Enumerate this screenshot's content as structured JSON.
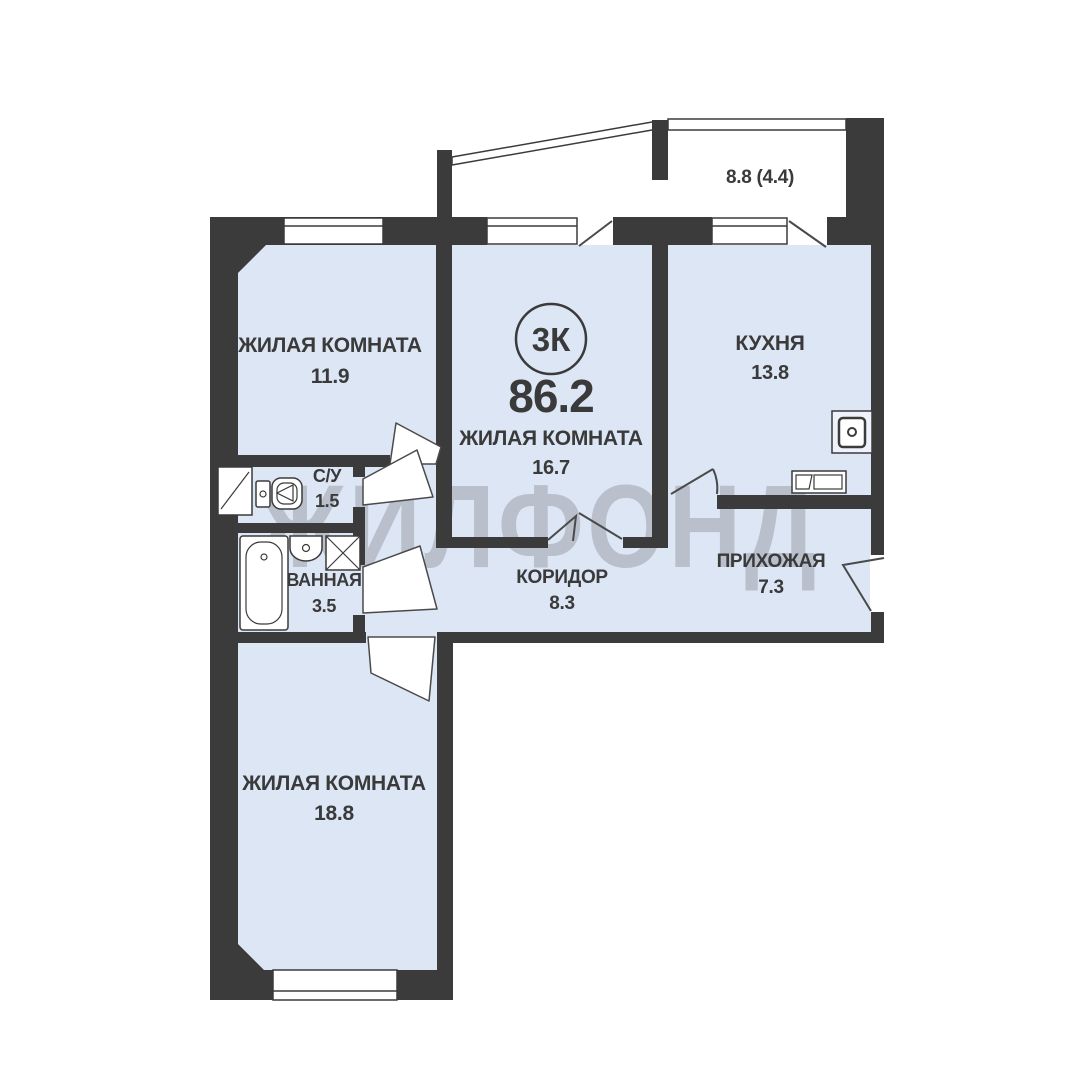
{
  "watermark": "ЖИЛФОНД",
  "badge_label": "3К",
  "total_area": "86.2",
  "balcony_area": "8.8 (4.4)",
  "rooms": {
    "living1": {
      "name": "ЖИЛАЯ КОМНАТА",
      "area": "11.9"
    },
    "living2": {
      "name": "ЖИЛАЯ КОМНАТА",
      "area": "16.7"
    },
    "kitchen": {
      "name": "КУХНЯ",
      "area": "13.8"
    },
    "wc": {
      "name": "С/У",
      "area": "1.5"
    },
    "bath": {
      "name": "ВАННАЯ",
      "area": "3.5"
    },
    "corridor": {
      "name": "КОРИДОР",
      "area": "8.3"
    },
    "hall": {
      "name": "ПРИХОЖАЯ",
      "area": "7.3"
    },
    "living3": {
      "name": "ЖИЛАЯ КОМНАТА",
      "area": "18.8"
    }
  },
  "colors": {
    "wall": "#3b3b3b",
    "room_fill": "#dce6f5",
    "watermark": "#b3b9c4",
    "label": "#3a3a3a"
  }
}
